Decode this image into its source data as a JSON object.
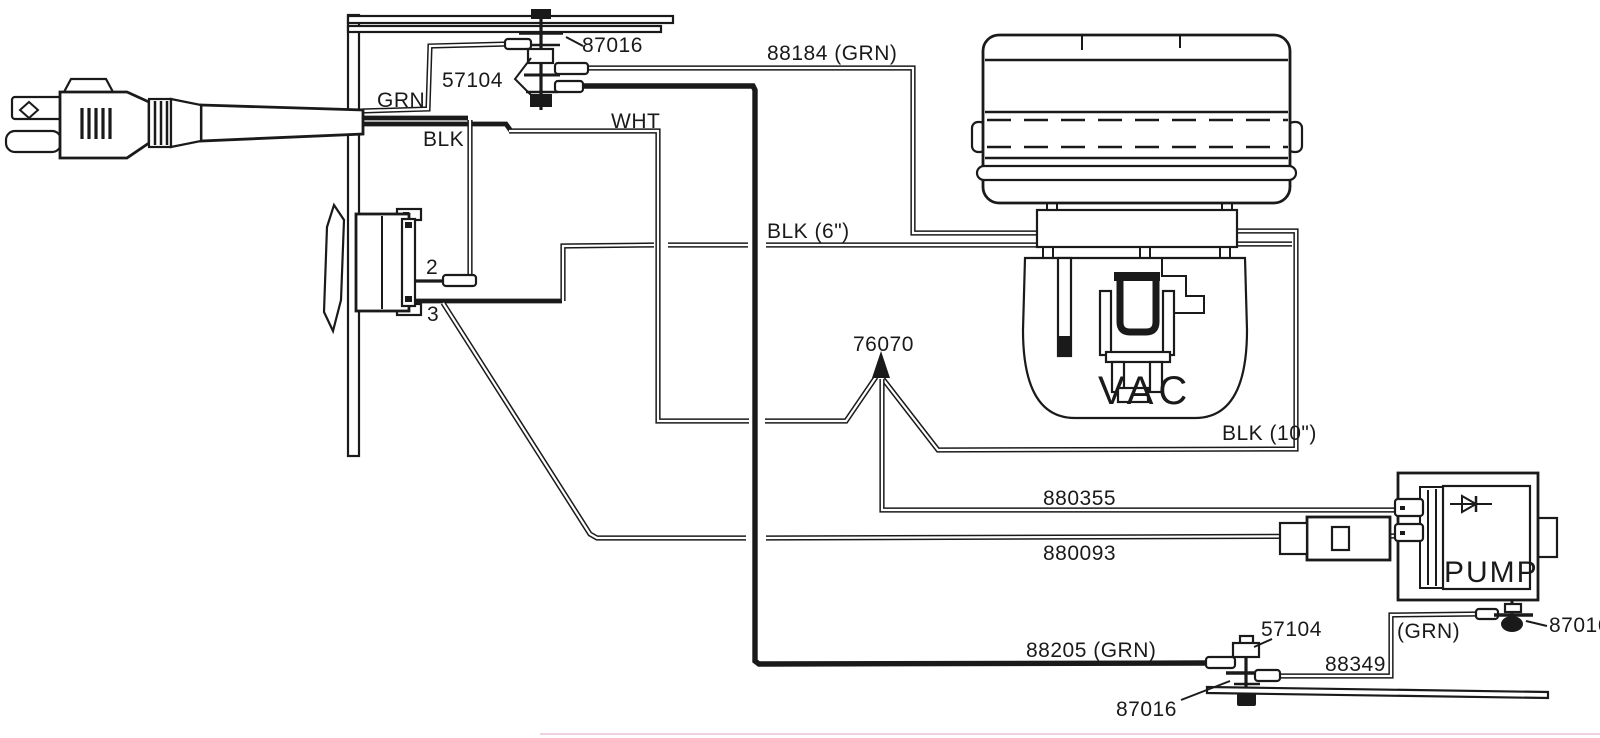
{
  "labels": {
    "wire_grn": "GRN",
    "wire_blk": "BLK",
    "wire_wht": "WHT",
    "stud_top_screw": "87016",
    "stud_top_terminals": "57104",
    "wire_88184": "88184 (GRN)",
    "switch_terminal_2": "2",
    "switch_terminal_3": "3",
    "wire_blk_6in": "BLK (6\")",
    "splice_76070": "76070",
    "motor": "VAC",
    "wire_blk_10in": "BLK (10\")",
    "wire_880355": "880355",
    "wire_880093": "880093",
    "pump": "PUMP",
    "wire_88205": "88205 (GRN)",
    "stud_bottom_terminals": "57104",
    "stud_bottom_screw": "87016",
    "wire_88349": "88349",
    "wire_88349_color": "(GRN)",
    "stud_right_screw": "87016"
  },
  "colors": {
    "line": "#1a1a1a",
    "background": "#ffffff",
    "scan_artifact": "#edc9da"
  }
}
